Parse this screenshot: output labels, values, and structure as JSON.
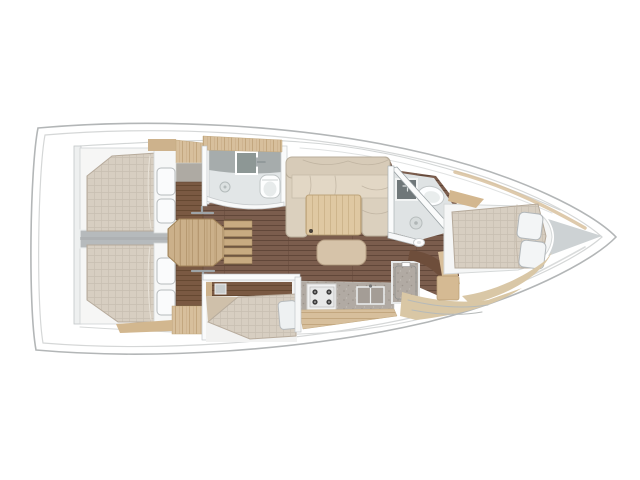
{
  "page": {
    "title": "Sailing yacht interior layout plan, top view, bow pointing right",
    "background": "#ffffff"
  },
  "vessel": {
    "type": "yacht-floor-plan",
    "orientation": "bow-right",
    "rooms": [
      {
        "id": "lazarette",
        "label": "Stern lazarette"
      },
      {
        "id": "aft-cabin-port",
        "label": "Aft double cabin (port)"
      },
      {
        "id": "aft-cabin-stbd",
        "label": "Aft double cabin (starboard)"
      },
      {
        "id": "companionway",
        "label": "Companionway ladder"
      },
      {
        "id": "aft-head",
        "label": "Aft bathroom with sink, toilet and shower drain"
      },
      {
        "id": "salon",
        "label": "Salon with sofa, table and ottoman"
      },
      {
        "id": "mid-berth",
        "label": "Mid single berth cabin"
      },
      {
        "id": "galley",
        "label": "Galley with stove, double sink and icebox"
      },
      {
        "id": "forward-head",
        "label": "Forward bathroom with angled wall"
      },
      {
        "id": "forward-cabin",
        "label": "Forward double cabin"
      },
      {
        "id": "bow-locker",
        "label": "Bow anchor locker"
      }
    ],
    "features": [
      "quilted double berths with two pillows each",
      "companionway ladder with five treads",
      "wood saloon table",
      "gas stove",
      "double galley sink",
      "two toilets with washbasins",
      "shower drains",
      "dark wood cabin sole planking"
    ]
  },
  "palette": {
    "hull_outline": "#b3b6b7",
    "hull_inner_line": "#d5d7d7",
    "bow_wedge": "#cdd2d4",
    "floor_base": "#7b5d4d",
    "floor_line": "#614739",
    "corridor": "#b6babc",
    "cabin_bg": "#f6f6f5",
    "mattress_base": "#d7cec1",
    "mattress_grid": "#c8bfb1",
    "mattress_edge": "#b6aa9b",
    "pillow": "#fafbfc",
    "pillow_edge": "#b7bbbd",
    "platform": "#f6f7f7",
    "platform_edge": "#d4d7d7",
    "wood_light": "#d7bf9c",
    "wood_light_grain": "#c3a77f",
    "wood_table": "#dfc8a2",
    "wood_table_grain": "#cdb389",
    "wood_tan": "#cbb08a",
    "wood_tan_grain": "#ab8e66",
    "wood_dark": "#7a5942",
    "wood_dark_grain": "#654831",
    "sofa": "#dbd0be",
    "sofa_seat": "#e2d7c5",
    "sofa_edge": "#b9ae9b",
    "counter": "#b1aaa3",
    "counter_dot": "#9c948c",
    "bath_floor": "#e2e6e7",
    "bath_counter": "#a6acac",
    "fixture_white": "#fdfefe",
    "fixture_edge": "#c2c7c8",
    "sink_dark": "#6f7779",
    "wall": "#fafbfb",
    "wall_edge": "#a9b0b3",
    "stove": "#f0f1f1",
    "burner": "#3e3e3e",
    "steel": "#9ea4a7"
  }
}
